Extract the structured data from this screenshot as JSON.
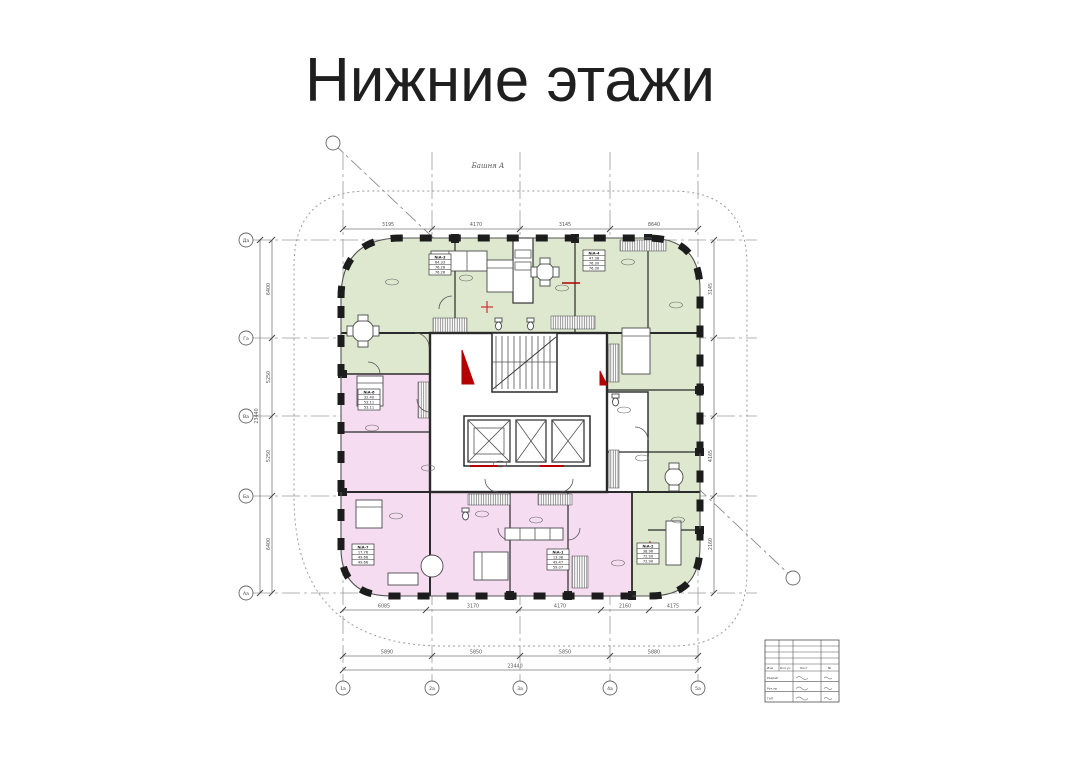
{
  "page": {
    "title": "Нижние этажи"
  },
  "colors": {
    "apartment_green": "#dde8cf",
    "apartment_pink": "#f6dcf1",
    "wall": "#1f1f1f",
    "accent_red": "#b40000",
    "line_gray": "#8a8a8a"
  },
  "drawing": {
    "tower_label": "Башня А",
    "grid": {
      "rows": [
        "Да",
        "Га",
        "Ва",
        "Ба",
        "Аа"
      ],
      "cols": [
        "1а",
        "2а",
        "3а",
        "4а",
        "5а"
      ]
    },
    "dims": {
      "top": [
        "3195",
        "4170",
        "3145",
        "8640"
      ],
      "bottom_inner": [
        "6085",
        "3170",
        "4170",
        "2160",
        "4175"
      ],
      "bottom_main": [
        "5890",
        "5850",
        "5850",
        "5880"
      ],
      "bottom_total": "23440",
      "left_chain": [
        "6400",
        "5250",
        "5250",
        "6400"
      ],
      "left_total": "23440",
      "right_chain": [
        "3145",
        "4165",
        "2160"
      ]
    },
    "apartments": [
      {
        "no": "№А-3",
        "areas": [
          "64.33",
          "76.26",
          "76.26"
        ]
      },
      {
        "no": "№А-4",
        "areas": [
          "47.38",
          "76.30",
          "76.30"
        ]
      },
      {
        "no": "№А-6",
        "areas": [
          "32.40",
          "53.11",
          "53.11"
        ]
      },
      {
        "no": "№А-7",
        "areas": [
          "17.76",
          "49.66",
          "49.66"
        ]
      },
      {
        "no": "№А-1",
        "areas": [
          "13.38",
          "49.47",
          "59.07"
        ]
      },
      {
        "no": "№А-2",
        "areas": [
          "38.96",
          "72.90",
          "72.90"
        ]
      }
    ],
    "title_block": {
      "header": [
        "Изм",
        "Кол.уч",
        "Лист",
        "№"
      ],
      "rows": [
        "Разраб",
        "Рук.пр",
        "ГАП"
      ]
    }
  }
}
